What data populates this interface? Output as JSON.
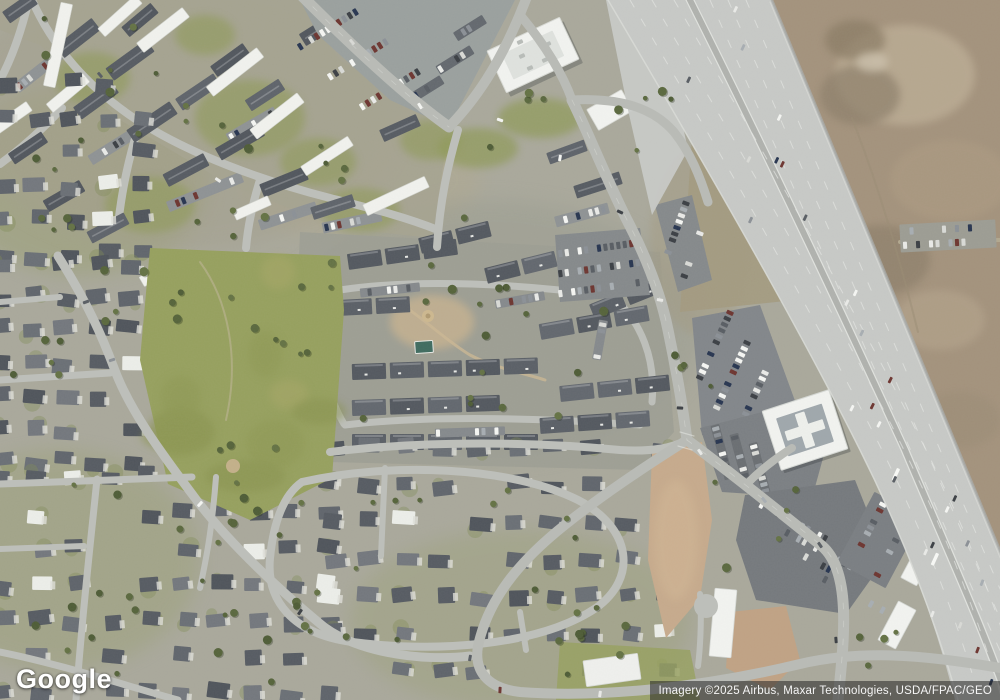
{
  "provider": {
    "logo_text": "Google"
  },
  "attribution": {
    "text": "Imagery ©2025 Airbus, Maxar Technologies, USDA/FPAC/GEO"
  },
  "palette": {
    "base": "#a9a89b",
    "park_green": "#96a05e",
    "grass": "#8f9a58",
    "dry_grass": "#aaa571",
    "desert": "#a3927c",
    "desert_light": "#bfb098",
    "desert_dark": "#8d7f6a",
    "dirt_pink": "#c6aa8c",
    "scrub": "#a39a80",
    "road": "#b9bbb6",
    "road_minor": "#bdbfba",
    "highway": "#c7c9c6",
    "highway_median": "#b0b2ae",
    "lane_paint": "#e4e6e2",
    "roof_dark": "#575c63",
    "roof_white": "#f1f2ee",
    "parking_dark": "#75797d",
    "building_white": "#f2f3f0",
    "concrete": "#dcdcd6",
    "pool": "#3f6b5f",
    "tree_green": "#55633a",
    "attribution_bg": "rgba(38,38,38,0.55)",
    "attribution_text": "#f5f5f5",
    "logo_color": "#ffffff"
  }
}
